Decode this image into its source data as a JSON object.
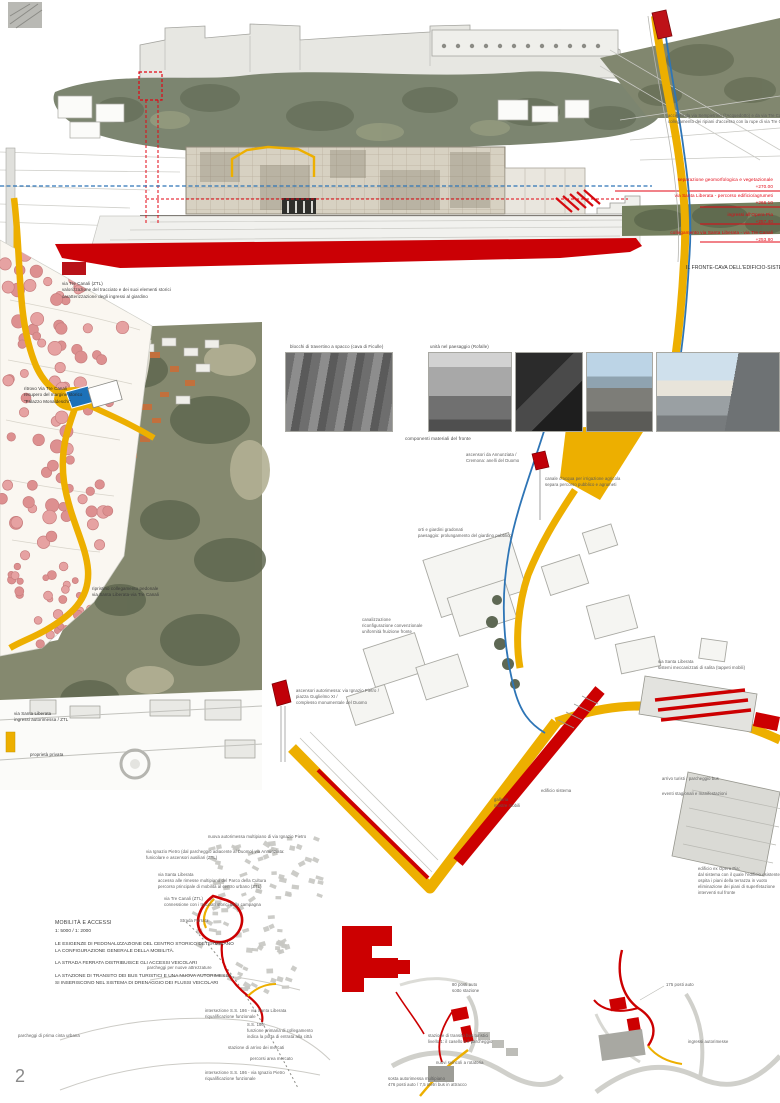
{
  "page": {
    "number": "2"
  },
  "colors": {
    "accent_yellow": "#EDAF00",
    "accent_red": "#CC0001",
    "line_red": "#E30613",
    "accent_blue": "#2E75B6",
    "tree_pink": "#E6A2A2"
  },
  "elevation": {
    "title": "IL FRONTE-CAVA DELL'EDIFICIO-SISTEMA 1: 250",
    "levels": [
      {
        "label": "separazione geomorfologica e vegetazionale",
        "quota": "+270.00"
      },
      {
        "label": "via Santa Liberata - percorso edificio/agrumeti",
        "quota": "+266.10"
      },
      {
        "label": "ingressi all'Opera Pia",
        "quota": "+257.40"
      },
      {
        "label": "collegamento via Santa Liberata - via Tre Canali",
        "quota": "+253.80"
      }
    ]
  },
  "mobility": {
    "title": "MOBILITÀ E ACCESSI",
    "scale": "1: 5000 / 1: 2000",
    "lines": [
      "LE ESIGENZE DI PEDONALIZZAZIONE DEL CENTRO STORICO DETERMINANO",
      "LA CONFIGURAZIONE GENERALE DELLA MOBILITÀ.",
      "LA STRADA FERRATA DISTRIBUISCE GLI ACCESSI VEICOLARI",
      "LA STAZIONE DI TRANSITO DEI BUS TURISTICI E UNA NUOVA AUTORIMESSA",
      "SI INSERISCONO NEL SISTEMA DI DRENAGGIO DEI FLUSSI VEICOLARI"
    ]
  },
  "annotations": [
    {
      "name": "note-access-top",
      "x": 668,
      "y": 113,
      "size": 4.2,
      "color": "#5a5a5a",
      "lines": [
        "accesso da via Sempietrino (l'Acquedotto) e da via Tre Canali",
        "collegamento dei ripiani d'accesso con la rupe di via Tre Canali"
      ]
    },
    {
      "name": "level-label-1",
      "right": 7,
      "y": 177,
      "size": 4.6,
      "color": "#E30613",
      "align": "right",
      "lines": [
        "separazione geomorfologica e vegetazionale",
        "+270.00"
      ]
    },
    {
      "name": "level-label-2",
      "right": 7,
      "y": 193,
      "size": 4.6,
      "color": "#E30613",
      "align": "right",
      "lines": [
        "via Santa Liberata - percorso edificio/agrumeti",
        "+266.10"
      ]
    },
    {
      "name": "level-label-3",
      "right": 7,
      "y": 212,
      "size": 4.6,
      "color": "#E30613",
      "align": "right",
      "lines": [
        "ingressi all'Opera Pia",
        "+257.40"
      ]
    },
    {
      "name": "level-label-4",
      "right": 7,
      "y": 230,
      "size": 4.6,
      "color": "#E30613",
      "align": "right",
      "lines": [
        "collegamento via Santa Liberata - via Tre Canali",
        "+253.80"
      ]
    },
    {
      "name": "section-title",
      "x": 686,
      "y": 265,
      "size": 5,
      "color": "#2a2a2a",
      "lines": [
        "IL FRONTE-CAVA DELL'EDIFICIO-SISTEMA 1: 250"
      ]
    },
    {
      "name": "legend-tre-canali",
      "x": 62,
      "y": 281,
      "size": 4.4,
      "color": "#3a3a3a",
      "lines": [
        "via Tre Canali (ZTL)",
        "valorizzazione del tracciato e dei suoi elementi storici",
        "caratterizzazione degli ingressi al giardino"
      ]
    },
    {
      "name": "note-ritrovo",
      "x": 24,
      "y": 386,
      "size": 4.4,
      "color": "#2a2a2a",
      "lines": [
        "ritrovo Via Tre Canali",
        "recupero del margine storico",
        "\"Palazzo Monaldeschi\""
      ]
    },
    {
      "name": "caption-travertino",
      "x": 290,
      "y": 344,
      "size": 4.4,
      "color": "#4a4a4a",
      "lines": [
        "blocchi di travertino a spacco (cava di Ficulle)"
      ]
    },
    {
      "name": "caption-paesaggio",
      "x": 430,
      "y": 344,
      "size": 4.4,
      "color": "#4a4a4a",
      "lines": [
        "unità nel paesaggio (Rofalle)"
      ]
    },
    {
      "name": "caption-componenti",
      "x": 405,
      "y": 436,
      "size": 4.6,
      "color": "#4a4a4a",
      "lines": [
        "componenti materiali del fronte"
      ]
    },
    {
      "name": "note-ascensori-annunziata",
      "x": 466,
      "y": 452,
      "size": 4.2,
      "color": "#5a5a5a",
      "lines": [
        "ascensori da Annunziata /",
        "Cremona: anelli del Duomo"
      ]
    },
    {
      "name": "note-canale",
      "x": 545,
      "y": 476,
      "size": 4.2,
      "color": "#5a5a5a",
      "lines": [
        "canale d'acqua per irrigazione agricola",
        "separa percorso pubblico e agrumeti"
      ]
    },
    {
      "name": "note-giardini-gradonati",
      "x": 418,
      "y": 527,
      "size": 4.2,
      "color": "#5a5a5a",
      "lines": [
        "orti e giardini gradonati",
        "paesaggio: prolungamento del giardino pubblico"
      ]
    },
    {
      "name": "note-canalizzazione",
      "x": 362,
      "y": 617,
      "size": 4.2,
      "color": "#5a5a5a",
      "lines": [
        "canalizzazione",
        "riconfigurazione convenzionale",
        "uniformità fruizione fronte"
      ]
    },
    {
      "name": "note-ripristino",
      "x": 92,
      "y": 586,
      "size": 4.4,
      "color": "#3a3a3a",
      "lines": [
        "ripristino collegamento pedonale",
        "via Santa Liberata-via Tre Canali"
      ]
    },
    {
      "name": "note-ingressi-ztl",
      "x": 14,
      "y": 711,
      "size": 4.4,
      "color": "#3a3a3a",
      "lines": [
        "via Santa Liberata",
        "ingressi autorimessa / ZTL"
      ]
    },
    {
      "name": "note-proprieta-privata",
      "x": 30,
      "y": 752,
      "size": 4.4,
      "color": "#3a3a3a",
      "lines": [
        "proprietà privata"
      ]
    },
    {
      "name": "note-ascensori-autorimessa",
      "x": 296,
      "y": 688,
      "size": 4.2,
      "color": "#5a5a5a",
      "lines": [
        "ascensori autorimessa: via Ignazio Pietro /",
        "piazza Guglielmo XI /",
        "complesso monumentale del Duomo"
      ]
    },
    {
      "name": "note-sistemi-meccanizzati",
      "x": 658,
      "y": 659,
      "size": 4.2,
      "color": "#5a5a5a",
      "lines": [
        "via Santa Liberata",
        "sistemi meccanizzati di salita (tappeti mobili)"
      ]
    },
    {
      "name": "note-galleria",
      "x": 494,
      "y": 797,
      "size": 4.2,
      "color": "#5a5a5a",
      "lines": [
        "galleria",
        "mostre mobili"
      ]
    },
    {
      "name": "note-edificio-sistema",
      "x": 541,
      "y": 788,
      "size": 4.2,
      "color": "#5a5a5a",
      "lines": [
        "edificio sistema"
      ]
    },
    {
      "name": "note-arrivo-turisti",
      "x": 662,
      "y": 776,
      "size": 4.2,
      "color": "#5a5a5a",
      "lines": [
        "arrivo turisti / parcheggio bus"
      ]
    },
    {
      "name": "note-eventi",
      "x": 662,
      "y": 791,
      "size": 4.2,
      "color": "#5a5a5a",
      "lines": [
        "eventi stagionali e manifestazioni"
      ]
    },
    {
      "name": "note-opera-pia",
      "x": 698,
      "y": 866,
      "size": 4.2,
      "color": "#5a5a5a",
      "lines": [
        "edificio ex Opera Pia:",
        "dal sistema con il quale l'edificio esistente",
        "ospita i piani della terrazza in vuoto",
        "eliminazione dei piani di superfetazione",
        "interventi sul fronte"
      ]
    },
    {
      "name": "note-nuova-autorimessa",
      "x": 208,
      "y": 834,
      "size": 4.2,
      "color": "#5a5a5a",
      "lines": [
        "nuova autorimessa multipiano di via Ignazio Pietro"
      ]
    },
    {
      "name": "note-via-ignazio",
      "x": 146,
      "y": 849,
      "size": 4.2,
      "color": "#5a5a5a",
      "lines": [
        "via Ignazio Pietro (dal parcheggio adiacente al Duomo) via Annunziata:",
        "funicolare e ascensori ausiliari (ZTL)"
      ]
    },
    {
      "name": "note-accesso-rimesse",
      "x": 158,
      "y": 872,
      "size": 4.2,
      "color": "#5a5a5a",
      "lines": [
        "via Santa Liberata",
        "accesso alle rimesse multipiano del Parco della Cultura",
        "percorso principale di mobilità al centro urbano (ZTL)"
      ]
    },
    {
      "name": "note-tre-canali-campagna",
      "x": 164,
      "y": 896,
      "size": 4.2,
      "color": "#5a5a5a",
      "lines": [
        "via Tre Canali (ZTL)",
        "connessione con i tracciati storici della campagna"
      ]
    },
    {
      "name": "note-strada-ferrata",
      "x": 180,
      "y": 918,
      "size": 4.2,
      "color": "#5a5a5a",
      "lines": [
        "Strada Ferrata"
      ]
    },
    {
      "name": "note-parcheggi-attrezzature",
      "x": 147,
      "y": 965,
      "size": 4.2,
      "color": "#5a5a5a",
      "lines": [
        "parcheggi per nuove attrezzature"
      ]
    },
    {
      "name": "note-parcheggi-cinta",
      "x": 18,
      "y": 1033,
      "size": 4.2,
      "color": "#5a5a5a",
      "lines": [
        "parcheggi di prima cinta urbana"
      ]
    },
    {
      "name": "note-intersezione-liberata",
      "x": 205,
      "y": 1008,
      "size": 4.2,
      "color": "#5a5a5a",
      "lines": [
        "intersezione S.S. 186 - via Santa Liberata",
        "riqualificazione funzionale"
      ]
    },
    {
      "name": "note-ss186",
      "x": 247,
      "y": 1022,
      "size": 4.2,
      "color": "#5a5a5a",
      "lines": [
        "S.S. 186:",
        "funzione primaria di collegamento",
        "indica la porta di entrata alla città"
      ]
    },
    {
      "name": "note-stazione-mercati",
      "x": 228,
      "y": 1045,
      "size": 4.2,
      "color": "#5a5a5a",
      "lines": [
        "stazione di arrivo dei mercati"
      ]
    },
    {
      "name": "note-percorsi-mercato",
      "x": 250,
      "y": 1056,
      "size": 4.2,
      "color": "#5a5a5a",
      "lines": [
        "percorsi area mercato"
      ]
    },
    {
      "name": "note-intersezione-ignazio",
      "x": 205,
      "y": 1070,
      "size": 4.2,
      "color": "#5a5a5a",
      "lines": [
        "intersezione S.S. 186 - via Ignazio Pietro",
        "riqualificazione funzionale"
      ]
    },
    {
      "name": "note-80-posti",
      "x": 452,
      "y": 982,
      "size": 4.2,
      "color": "#5a5a5a",
      "lines": [
        "80 posti auto",
        "sotto stazione"
      ]
    },
    {
      "name": "note-stazione-transito",
      "x": 428,
      "y": 1033,
      "size": 4.2,
      "color": "#5a5a5a",
      "lines": [
        "stazione di transito bus turistici",
        "livello 1: il casello e il parcheggio"
      ]
    },
    {
      "name": "note-nuovi-svincoli",
      "x": 436,
      "y": 1060,
      "size": 4.2,
      "color": "#5a5a5a",
      "lines": [
        "nuovi svincoli a rotatoria"
      ]
    },
    {
      "name": "note-sosta-autorimessa",
      "x": 388,
      "y": 1076,
      "size": 4.2,
      "color": "#5a5a5a",
      "lines": [
        "sosta autorimessa multipiano",
        "476 posti auto / 7,5 metri bus in attracco"
      ]
    },
    {
      "name": "note-175-posti",
      "x": 666,
      "y": 982,
      "size": 4.2,
      "color": "#5a5a5a",
      "lines": [
        "175 posti auto"
      ]
    },
    {
      "name": "note-ingressi-autorimesse",
      "x": 688,
      "y": 1039,
      "size": 4.2,
      "color": "#5a5a5a",
      "lines": [
        "ingressi autorimesse"
      ]
    }
  ]
}
